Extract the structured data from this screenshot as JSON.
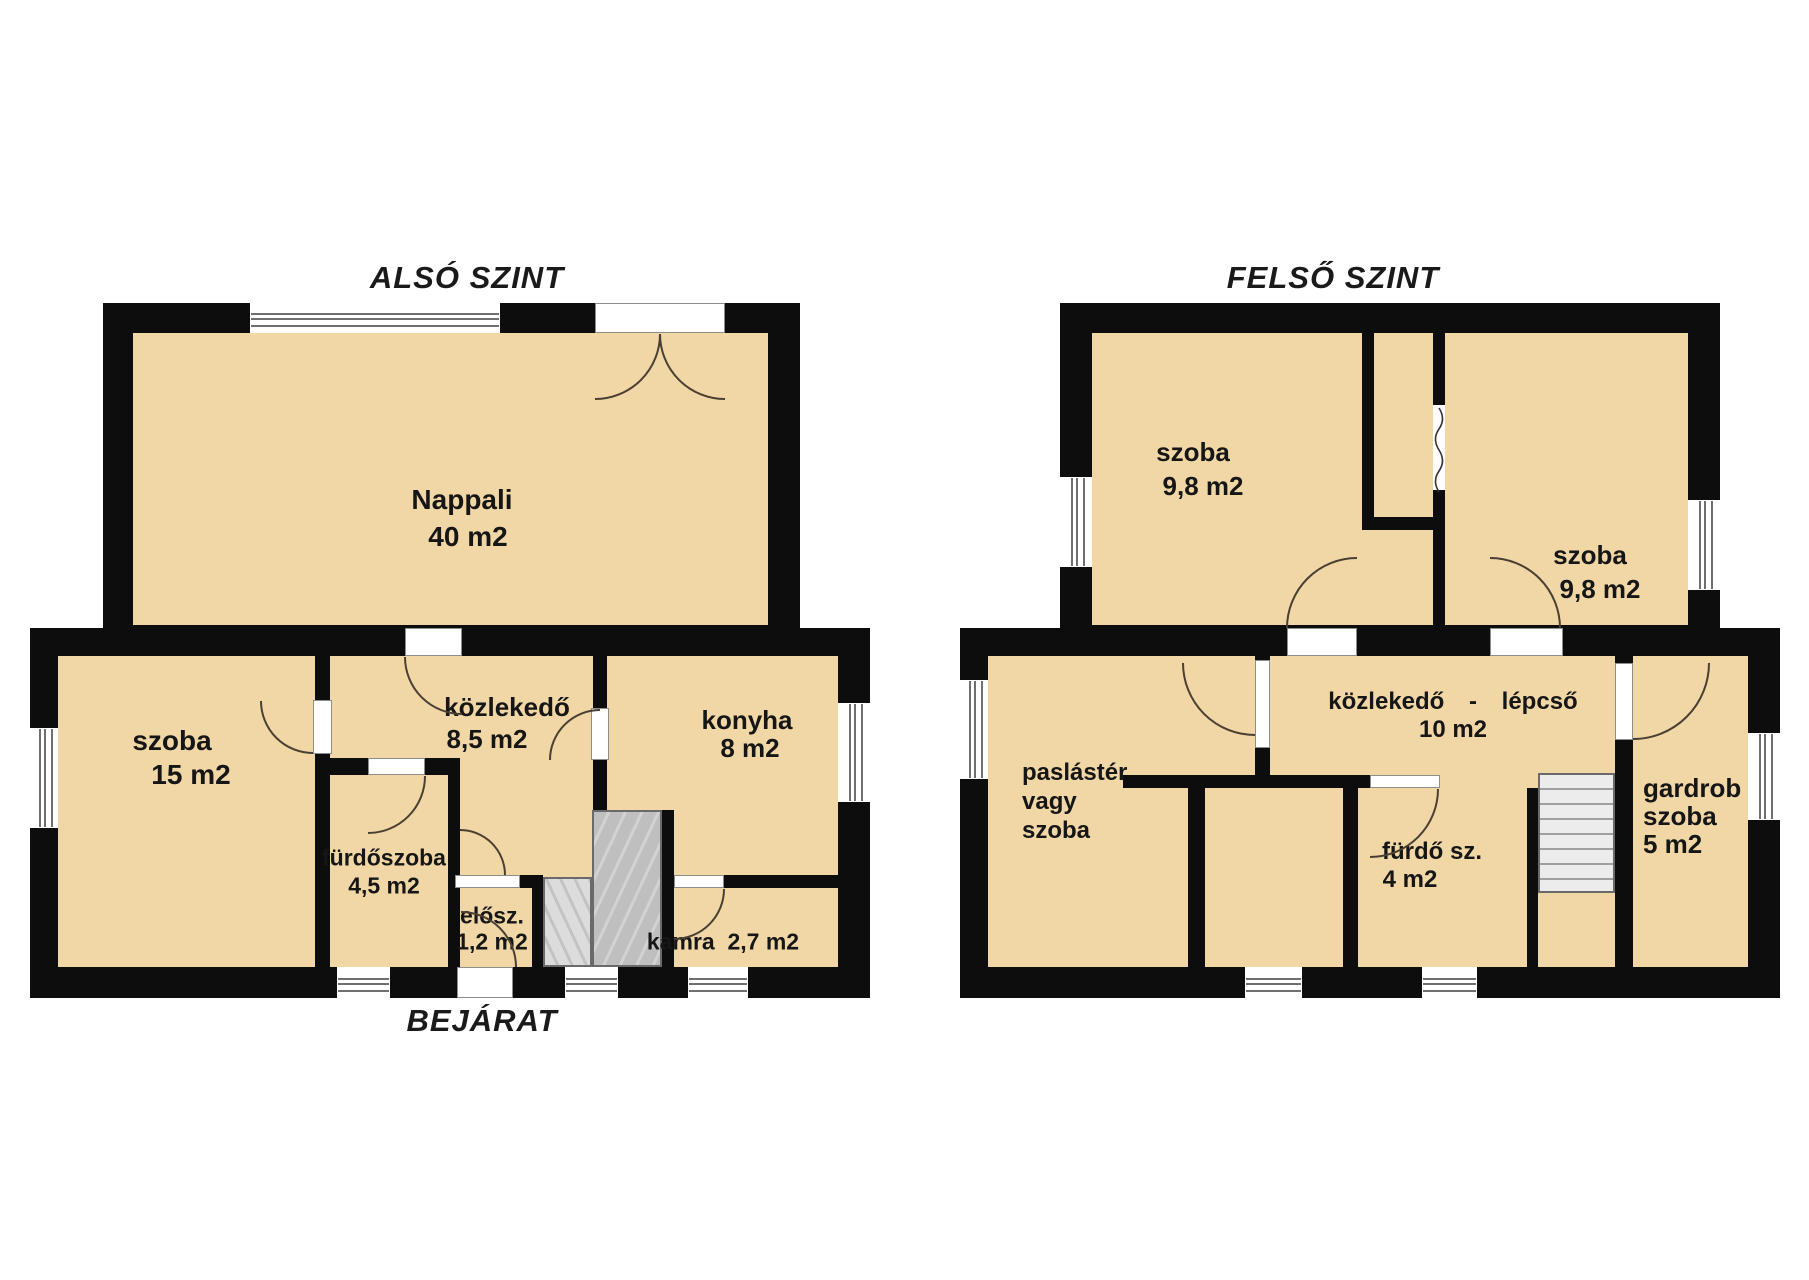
{
  "colors": {
    "floor": "#f1d7a6",
    "wall": "#0d0d0d",
    "arc": "#4a3f33"
  },
  "floors": {
    "lower": {
      "title": "ALSÓ SZINT",
      "entrance_label": "BEJÁRAT",
      "rooms": {
        "nappali": {
          "name": "Nappali",
          "area": "40 m2"
        },
        "szoba": {
          "name": "szoba",
          "area": "15 m2"
        },
        "kozlekedo": {
          "name": "közlekedő",
          "area": "8,5 m2"
        },
        "konyha": {
          "name": "konyha",
          "area": "8 m2"
        },
        "furdoszoba": {
          "name": "fürdőszoba",
          "area": "4,5 m2"
        },
        "elosz": {
          "name": "elősz.",
          "area": "1,2 m2"
        },
        "kamra": {
          "name": "kamra",
          "area": "2,7 m2"
        }
      }
    },
    "upper": {
      "title": "FELSŐ SZINT",
      "rooms": {
        "szoba_left": {
          "name": "szoba",
          "area": "9,8 m2"
        },
        "szoba_right": {
          "name": "szoba",
          "area": "9,8 m2"
        },
        "kozlekedo_lepcso": {
          "name": "közlekedő - lépcső",
          "area": "10 m2"
        },
        "paslaster": {
          "line1": "paslástér",
          "line2": "vagy",
          "line3": "szoba"
        },
        "furdo": {
          "name": "fürdő sz.",
          "area": "4 m2"
        },
        "gardrob": {
          "line1": "gardrob",
          "line2": "szoba",
          "line3": "5 m2"
        }
      }
    }
  }
}
